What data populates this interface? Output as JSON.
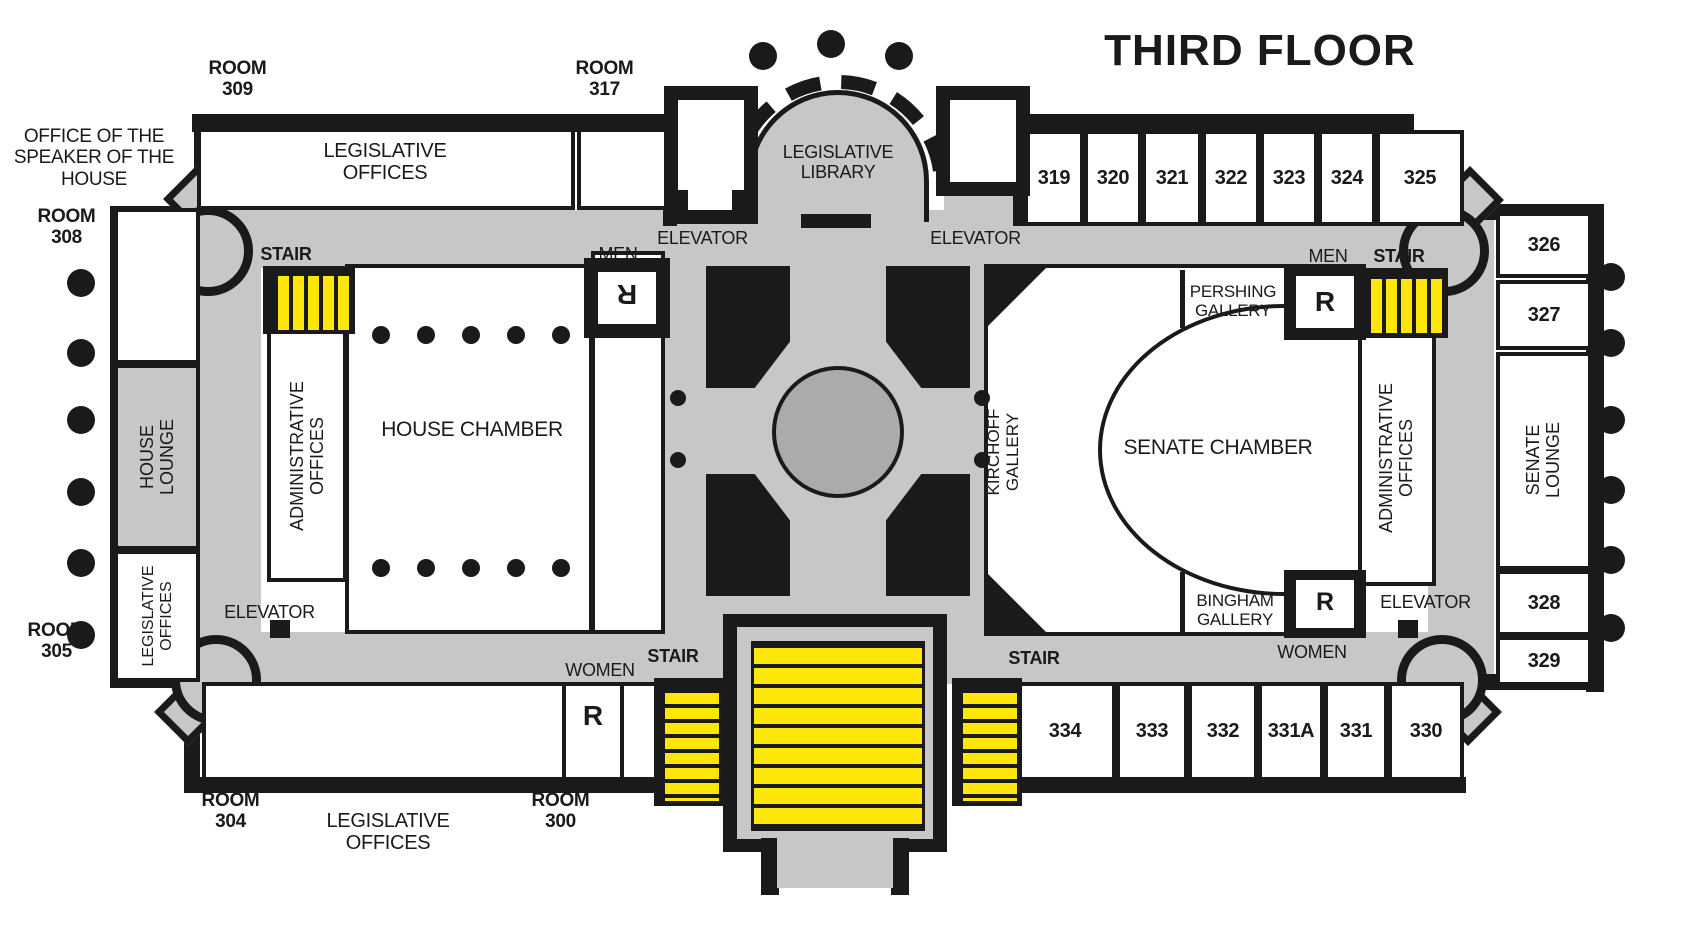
{
  "title": "THIRD FLOOR",
  "colors": {
    "walls": "#1a1a1a",
    "corridor_gray": "#c6c7c9",
    "rotunda_circle_gray": "#a9abad",
    "stair_yellow": "#ffe60a",
    "room_white": "#ffffff"
  },
  "exterior": {
    "room309": "ROOM\n309",
    "room317": "ROOM\n317",
    "speaker_office": "OFFICE  OF THE\nSPEAKER OF THE\nHOUSE",
    "room308": "ROOM\n308",
    "room305": "ROOM\n305",
    "room304": "ROOM\n304",
    "room300": "ROOM\n300",
    "legislative_offices_bottom": "LEGISLATIVE\nOFFICES"
  },
  "rooms": {
    "legislative_offices_top": "LEGISLATIVE\nOFFICES",
    "legislative_library": "LEGISLATIVE\nLIBRARY",
    "house_chamber": "HOUSE CHAMBER",
    "senate_chamber": "SENATE CHAMBER",
    "house_lounge": "HOUSE\nLOUNGE",
    "senate_lounge": "SENATE\nLOUNGE",
    "admin_offices_west": "ADMINISTRATIVE\nOFFICES",
    "admin_offices_east": "ADMINISTRATIVE\nOFFICES",
    "legislative_offices_west": "LEGISLATIVE\nOFFICES",
    "pershing_gallery": "PERSHING\nGALLERY",
    "kirchoff_gallery": "KIRCHOFF\nGALLERY",
    "bingham_gallery": "BINGHAM\nGALLERY"
  },
  "room_numbers": {
    "top": [
      "319",
      "320",
      "321",
      "322",
      "323",
      "324",
      "325"
    ],
    "east": [
      "326",
      "327",
      "328",
      "329"
    ],
    "south": [
      "334",
      "333",
      "332",
      "331A",
      "331",
      "330"
    ]
  },
  "labels": {
    "stair": "STAIR",
    "men": "MEN",
    "women": "WOMEN",
    "elevator": "ELEVATOR",
    "restroom": "R"
  }
}
